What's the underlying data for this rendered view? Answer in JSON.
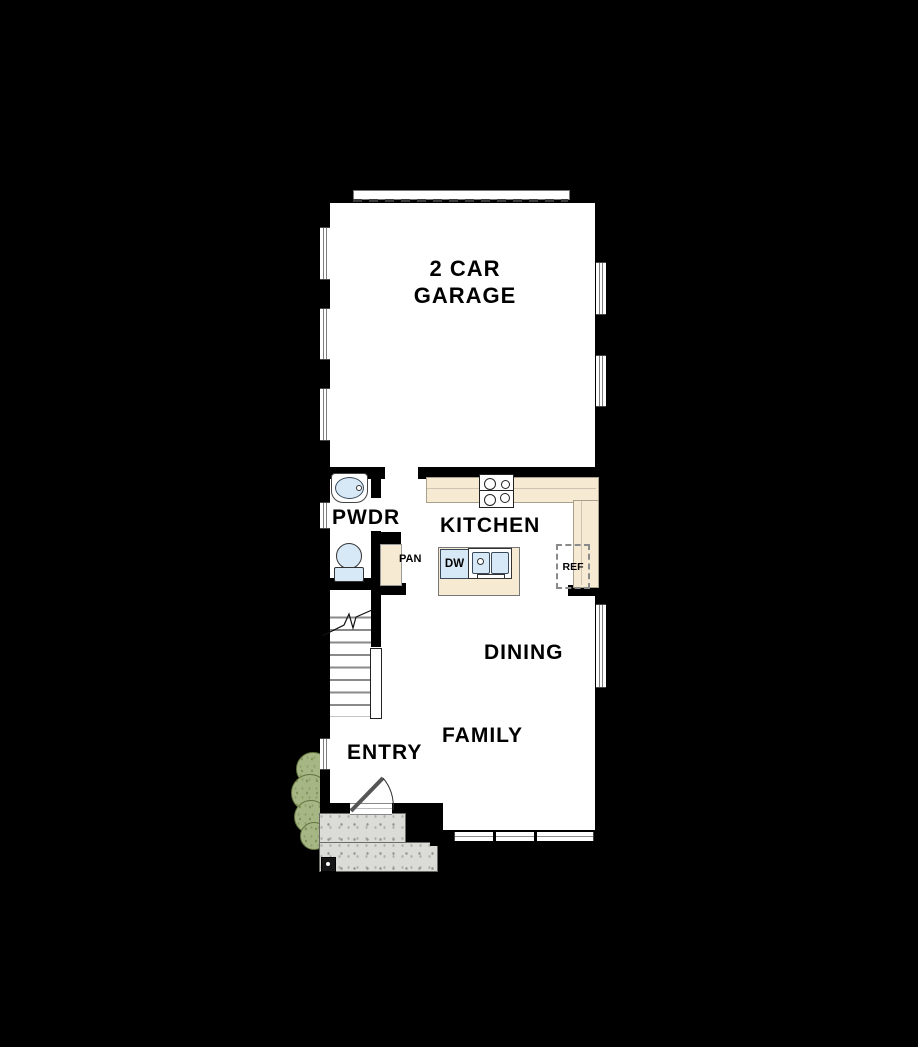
{
  "plan": {
    "rooms": {
      "garage": "2 CAR GARAGE",
      "powder_room": "PWDR",
      "kitchen": "KITCHEN",
      "pantry": "PAN",
      "dining": "DINING",
      "family": "FAMILY",
      "entry": "ENTRY"
    },
    "appliances": {
      "dishwasher": "DW",
      "refrigerator": "REF"
    },
    "colors": {
      "wall": "#000000",
      "floor": "#ffffff",
      "counter": "#f7ead2",
      "fixture_blue": "#d7e8f6",
      "porch_concrete": "#dbdbd8",
      "shrub_green": "#a6b685",
      "background": "#000000"
    }
  }
}
